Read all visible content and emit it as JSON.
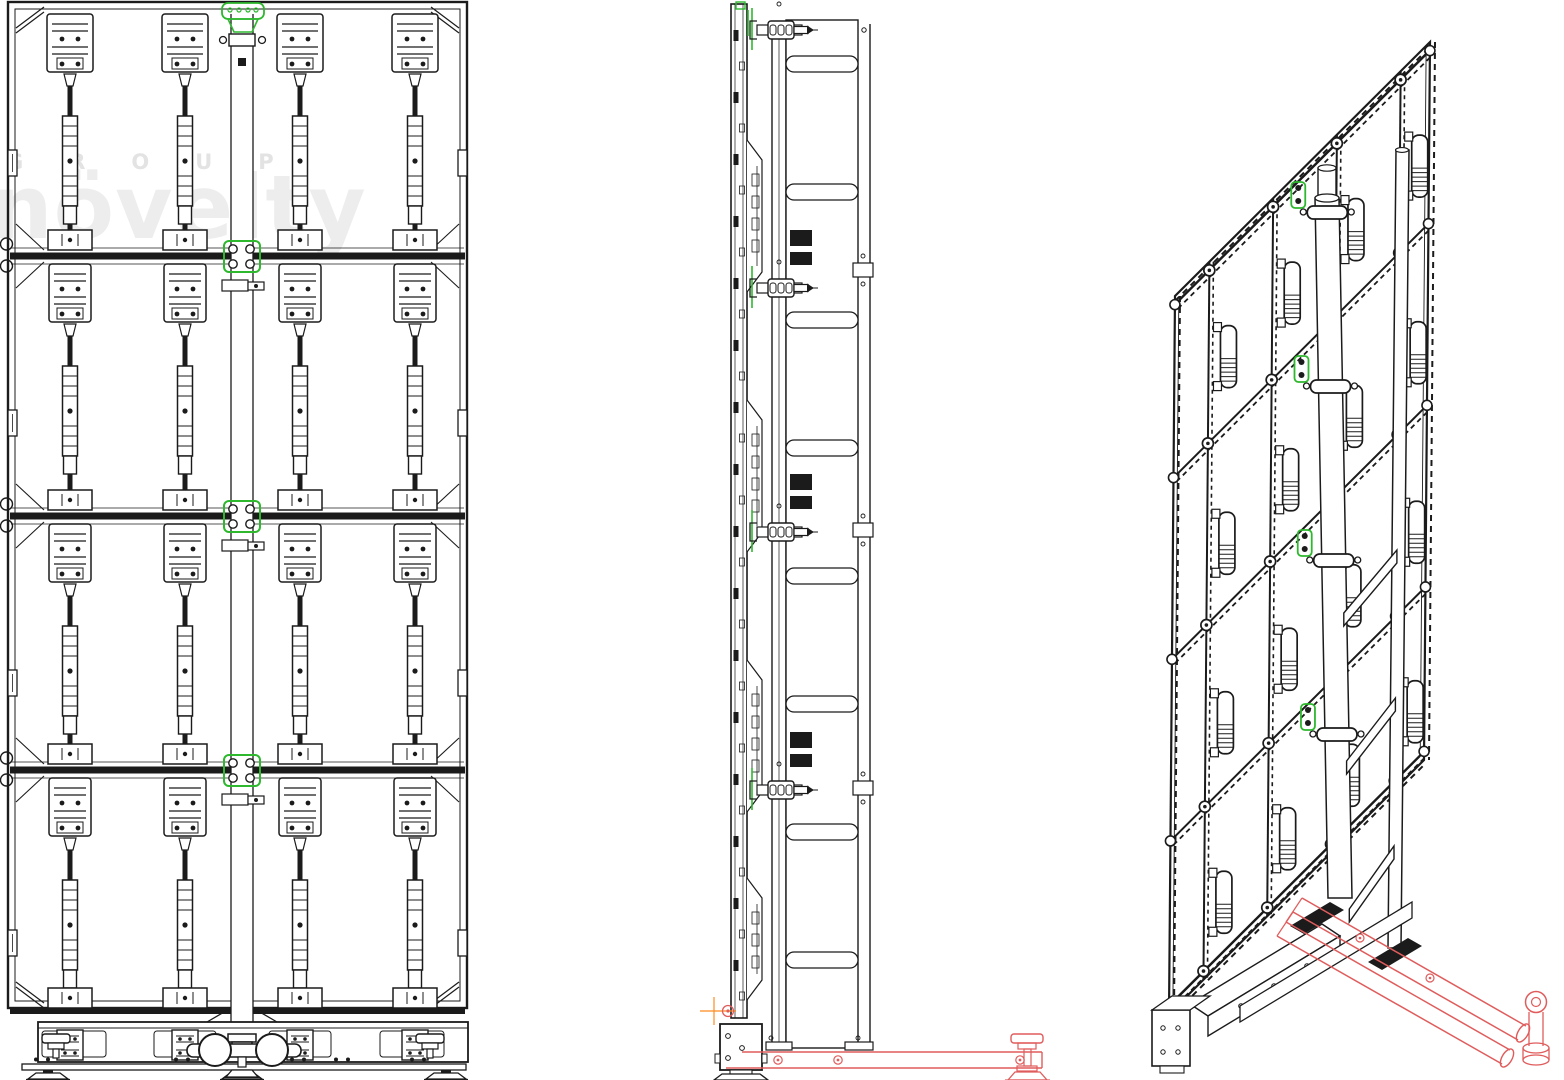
{
  "watermark": {
    "line1": "GROUP",
    "line2": "növelty"
  },
  "colors": {
    "line": "#1b1b1b",
    "green": "#2eb82e",
    "red": "#e05c5c",
    "orange": "#ff8a1e",
    "watermark_small": "#e3e3e3",
    "watermark_large": "#ededed",
    "background": "#ffffff"
  },
  "views": [
    {
      "id": "front",
      "name": "front-elevation"
    },
    {
      "id": "side",
      "name": "side-elevation"
    },
    {
      "id": "iso",
      "name": "isometric-projection"
    }
  ],
  "structure": {
    "front": {
      "beams_y": [
        256,
        516,
        770
      ],
      "mullions_x": [
        70,
        185,
        300,
        415
      ],
      "row_tops": [
        12,
        262,
        522,
        776
      ],
      "row_bottoms": [
        252,
        512,
        766,
        1010
      ],
      "edge_latch_y": [
        150,
        410,
        670,
        930
      ],
      "pole": {
        "x1": 231,
        "x2": 253,
        "top": 14,
        "bottom": 1034
      },
      "base_panels": [
        [
          42,
          64
        ],
        [
          154,
          62
        ],
        [
          269,
          62
        ],
        [
          380,
          64
        ]
      ],
      "base_ratchet_x": [
        70,
        185,
        300,
        415
      ],
      "base_jack_x": [
        56,
        430
      ],
      "base_holes_x": [
        36,
        48,
        176,
        188,
        292,
        304,
        336,
        348,
        412,
        424
      ],
      "feet_x": [
        48,
        242,
        446
      ],
      "wheels": {
        "cx1": 215,
        "cx2": 272,
        "cy": 1050,
        "r": 16
      }
    },
    "side": {
      "bracket_spans": [
        [
          140,
          292
        ],
        [
          400,
          552
        ],
        [
          660,
          812
        ],
        [
          878,
          1000
        ]
      ],
      "clamp_ys": [
        30,
        288,
        532,
        790
      ],
      "rung_ys": [
        64,
        192,
        320,
        448,
        576,
        704,
        832,
        960
      ],
      "splice_ys": [
        270,
        530,
        788
      ],
      "red_hole_x": [
        778,
        838,
        1020
      ]
    },
    "iso": {
      "tl": [
        1175,
        296
      ],
      "u": [
        255,
        -254
      ],
      "v": [
        -6,
        718
      ],
      "rail_ts": [
        0.012,
        0.253,
        0.506,
        0.759,
        0.988
      ],
      "mullion_ss": [
        0.135,
        0.385,
        0.635,
        0.885
      ],
      "handle_ts": [
        0.16,
        0.42,
        0.67,
        0.92
      ],
      "pole_top": [
        1327,
        198
      ],
      "pole_bot": [
        1340,
        898
      ],
      "collar_ys": [
        212,
        386,
        560,
        734
      ],
      "rail_top": [
        1402,
        150
      ],
      "rail_bot": [
        1394,
        948
      ],
      "rung_ys": [
        620,
        768,
        916
      ]
    }
  }
}
